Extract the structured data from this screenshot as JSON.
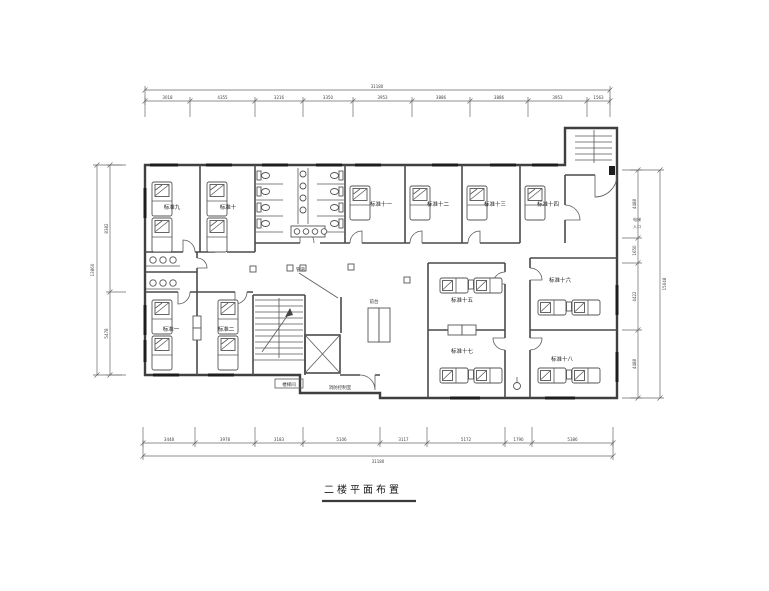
{
  "title": "二楼平面布置",
  "colors": {
    "background": "#ffffff",
    "walls": "#3f3f3f",
    "furniture": "#5a5a5a",
    "dimensions": "#6a6a6a",
    "text": "#222222"
  },
  "rooms": {
    "upper": [
      "标准九",
      "标准十",
      "标准十一",
      "标准十二",
      "标准十三",
      "标准十四"
    ],
    "lower_left": [
      "标准一",
      "标准二"
    ],
    "right_wing": [
      "标准十五",
      "标准十六",
      "标准十七",
      "标准十八"
    ]
  },
  "annotations": {
    "duct": "管道",
    "front_desk": "前台",
    "stair_box": "楼梯间",
    "fire_control": "消防控制室",
    "elevator_entry": {
      "line1": "电梯",
      "line2": "入口"
    }
  },
  "dimensions": {
    "top": {
      "total": "31180",
      "segments": [
        "3018",
        "4355",
        "3216",
        "3350",
        "3953",
        "3886",
        "3886",
        "3953",
        "1563"
      ]
    },
    "bottom": {
      "total": "31180",
      "segments": [
        "3448",
        "3978",
        "3183",
        "5106",
        "3117",
        "5172",
        "1790",
        "5386"
      ]
    },
    "left": {
      "total": "13860",
      "segments": [
        "8382",
        "5478"
      ]
    },
    "right": {
      "total": "15048",
      "segments": [
        "4488",
        "1650",
        "4422",
        "4488"
      ]
    }
  }
}
